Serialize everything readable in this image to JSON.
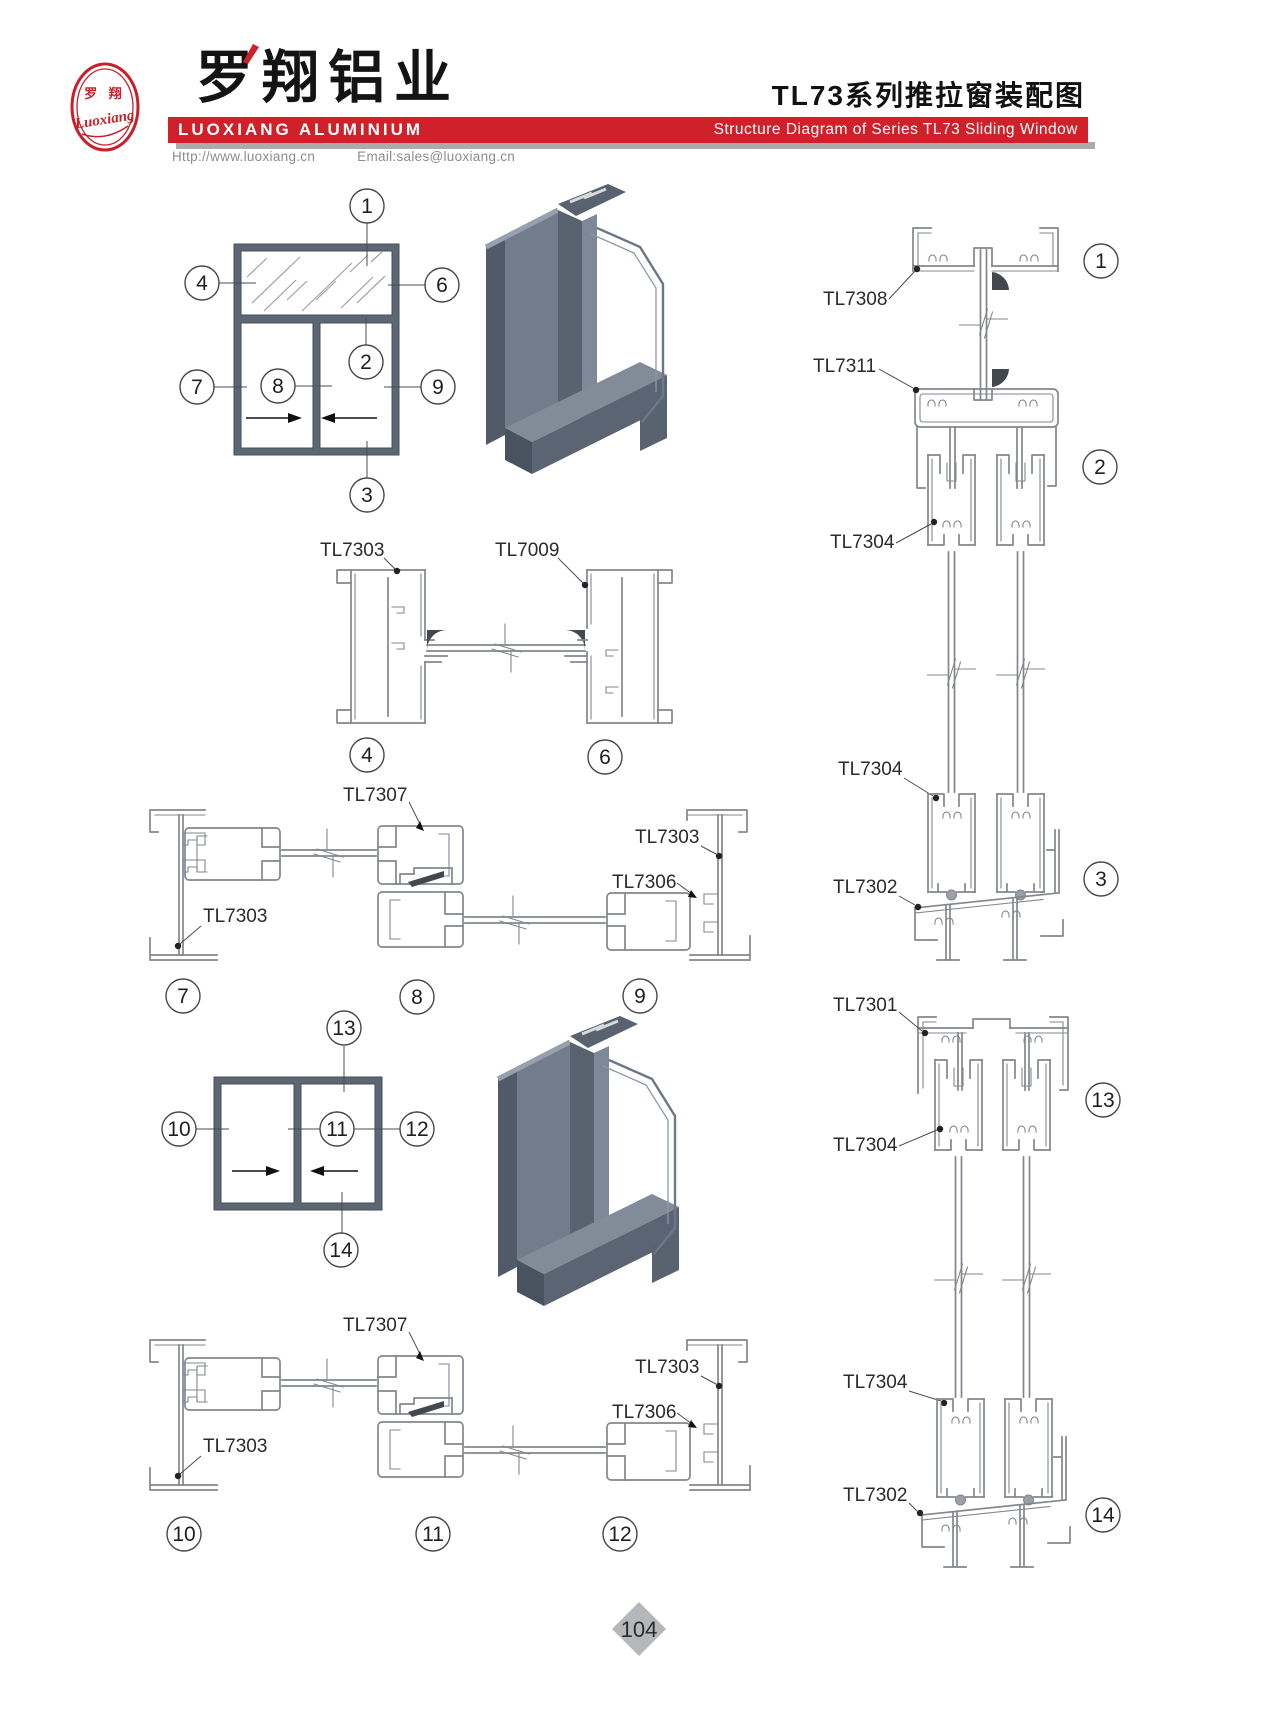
{
  "header": {
    "logo_cn": "罗 翔",
    "logo_script": "Luoxiang",
    "company_cn": "罗翔铝业",
    "company_en": "LUOXIANG ALUMINIUM",
    "website": "Http://www.luoxiang.cn",
    "email": "Email:sales@luoxiang.cn",
    "title_cn": "TL73系列推拉窗装配图",
    "title_en": "Structure Diagram of Series TL73 Sliding Window"
  },
  "page": {
    "number": "104"
  },
  "callouts": {
    "n1": "1",
    "n2": "2",
    "n3": "3",
    "n4": "4",
    "n6": "6",
    "n7": "7",
    "n8": "8",
    "n9": "9",
    "n10": "10",
    "n11": "11",
    "n12": "12",
    "n13": "13",
    "n14": "14"
  },
  "parts": {
    "tl7301": "TL7301",
    "tl7302": "TL7302",
    "tl7303": "TL7303",
    "tl7304": "TL7304",
    "tl7306": "TL7306",
    "tl7307": "TL7307",
    "tl7308": "TL7308",
    "tl7311": "TL7311",
    "tl7009": "TL7009"
  },
  "colors": {
    "accent_red": "#d0202a",
    "line_gray": "#83878c",
    "frame_slate": "#5d6673",
    "diamond_gray": "#b5b8bb"
  }
}
